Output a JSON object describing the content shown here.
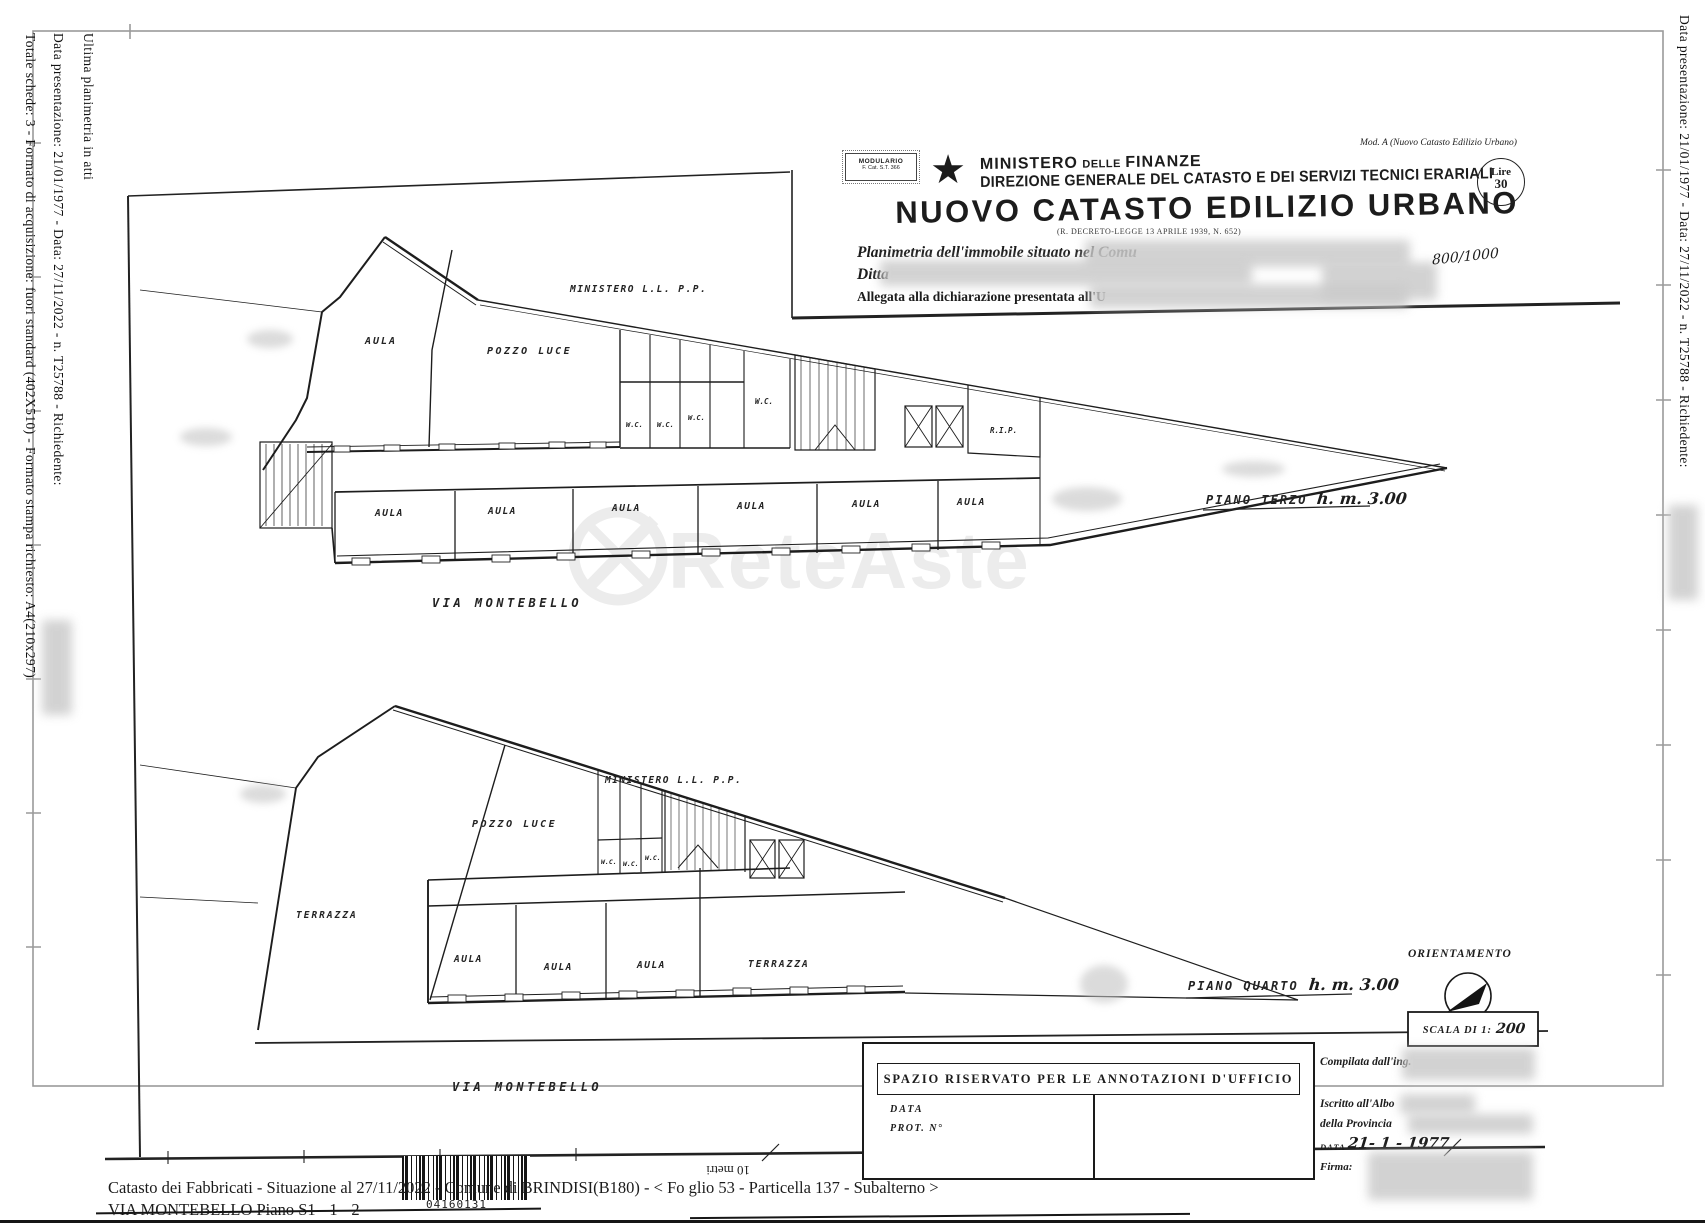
{
  "colors": {
    "ink": "#1c1c1c",
    "frame": "#9a9a9a",
    "watermark": "#ececec"
  },
  "margins": {
    "left_line1": "Ultima planimetria in atti",
    "left_line2": "Data presentazione: 21/01/1977 - Data: 27/11/2022 - n. T25788 - Richiedente:",
    "left_line3": "Totale schede: 3 - Formato di acquisizione: fuori standard (402X510) - Formato stampa richiesto: A4(210x297)",
    "right_line1": "Data presentazione: 21/01/1977 - Data: 27/11/2022 - n. T25788 - Richiedente:"
  },
  "header": {
    "modulario_line1": "MODULARIO",
    "modulario_line2": "F. Cat. S.T. 366",
    "ministero_1": "MINISTERO",
    "ministero_2": "DELLE",
    "ministero_3": "FINANZE",
    "direzione": "DIREZIONE GENERALE DEL CATASTO E DEI SERVIZI TECNICI ERARIALI",
    "titolo": "NUOVO  CATASTO  EDILIZIO  URBANO",
    "decreto": "(R. DECRETO-LEGGE 13 APRILE 1939, N. 652)",
    "mod_a": "Mod. A (Nuovo Catasto Edilizio Urbano)",
    "lire_label": "Lire",
    "lire_value": "30",
    "planimetria": "Planimetria dell'immobile situato nel Comu",
    "ditta": "Ditta",
    "allegata": "Allegata alla dichiarazione presentata all'U",
    "stamp": "800/1000"
  },
  "plans": {
    "labels": {
      "aula": "AULA",
      "pozzo": "POZZO LUCE",
      "ministero": "MINISTERO L.L. P.P.",
      "wc": "W.C.",
      "rip": "R.I.P.",
      "via": "VIA MONTEBELLO",
      "terrazza": "TERRAZZA"
    },
    "plan1": {
      "piano": "PIANO TERZO",
      "altezza": "h. m. 3.00"
    },
    "plan2": {
      "piano": "PIANO QUARTO",
      "altezza": "h. m. 3.00"
    }
  },
  "compass": {
    "title": "ORIENTAMENTO",
    "scala_prefix": "SCALA DI 1:",
    "scala_value": "200"
  },
  "annotations_box": {
    "title": "SPAZIO RISERVATO PER LE ANNOTAZIONI D'UFFICIO",
    "data_label": "DATA",
    "prot_label": "PROT. N°"
  },
  "office": {
    "compilata": "Compilata dall'ing.",
    "iscritto": "Iscritto all'Albo",
    "della": "della Provincia",
    "data_label": "DATA",
    "data_value": "21- 1 - 1977",
    "firma": "Firma:"
  },
  "footer": {
    "line1": "Catasto dei Fabbricati - Situazione al 27/11/2022 - Comune di BRINDISI(B180) - <  Fo glio 53 - Particella  137 - Subalterno   >",
    "line2": "VIA MONTEBELLO Piano S1 - 1 - 2",
    "barcode_number": "04160131",
    "scale_label": "10 metri"
  },
  "watermark": {
    "text": "ReteAste"
  }
}
